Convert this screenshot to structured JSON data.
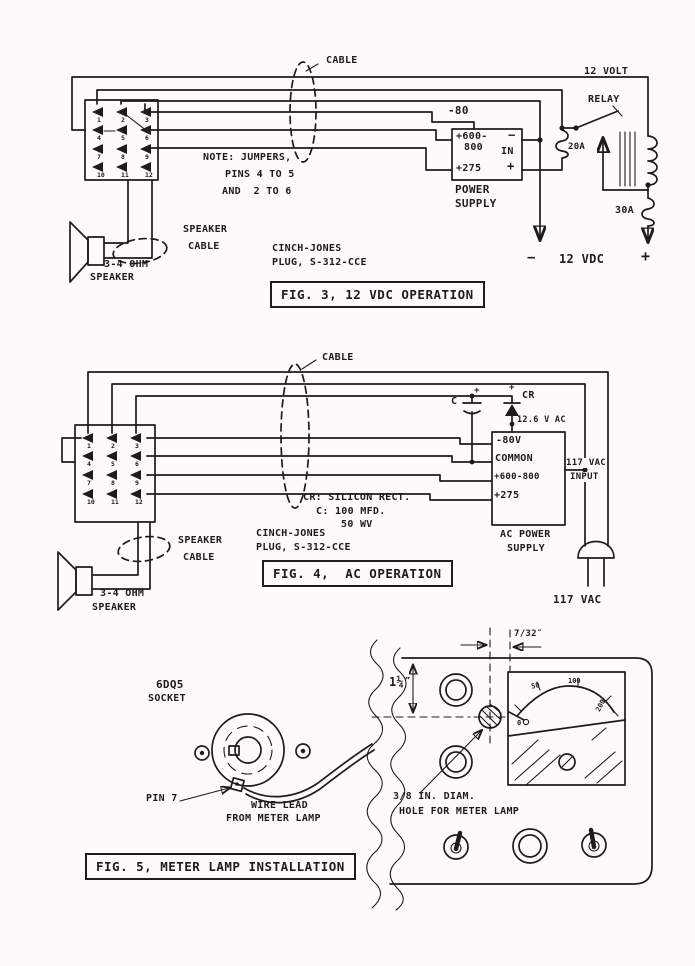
{
  "page": {
    "ink": "#1e1c1a",
    "paper": "#fcfbf7"
  },
  "fig3": {
    "cable": "CABLE",
    "note1": "NOTE: JUMPERS,",
    "note2": "PINS 4 TO 5",
    "note3": "AND  2 TO 6",
    "relay1": "12 VOLT",
    "relay2": "RELAY",
    "ps_wire": "-80",
    "ps_row1": "+600-",
    "ps_row2": "800",
    "ps_in": "IN",
    "ps_row3": "+275",
    "ps_neg": "−",
    "ps_pos": "+",
    "ps_cap1": "POWER",
    "ps_cap2": "SUPPLY",
    "fuse_20": "20A",
    "fuse_30": "30A",
    "dc_neg": "−",
    "dc": "12 VDC",
    "dc_pos": "+",
    "spkr_cable1": "SPEAKER",
    "spkr_cable2": "CABLE",
    "spkr1": "3-4 OHM",
    "spkr2": "SPEAKER",
    "plug1": "CINCH-JONES",
    "plug2": "PLUG, S-312-CCE",
    "caption": "FIG. 3, 12 VDC OPERATION",
    "pins": [
      "1",
      "2",
      "3",
      "4",
      "5",
      "6",
      "7",
      "8",
      "9",
      "10",
      "11",
      "12"
    ]
  },
  "fig4": {
    "cable": "CABLE",
    "c_plus": "+",
    "c_label": "C",
    "cr_plus": "+",
    "cr_label": "CR",
    "vac126": "12.6 V AC",
    "ps_row1": "-80V",
    "ps_row2": "COMMON",
    "ps_row3": "+600-800",
    "ps_row4": "+275",
    "ps_cap1": "AC POWER",
    "ps_cap2": "SUPPLY",
    "input1": "117 VAC",
    "input2": "INPUT",
    "vac117": "117 VAC",
    "cr_note": "CR: SILICON RECT.",
    "c_note": "C: 100 MFD.",
    "c_note2": "50 WV",
    "spkr_cable1": "SPEAKER",
    "spkr_cable2": "CABLE",
    "spkr1": "3-4 OHM",
    "spkr2": "SPEAKER",
    "plug1": "CINCH-JONES",
    "plug2": "PLUG, S-312-CCE",
    "caption": "FIG. 4,  AC OPERATION",
    "pins": [
      "1",
      "2",
      "3",
      "4",
      "5",
      "6",
      "7",
      "8",
      "9",
      "10",
      "11",
      "12"
    ]
  },
  "fig5": {
    "socket1": "6DQ5",
    "socket2": "SOCKET",
    "pin7": "PIN 7",
    "wire1": "WIRE LEAD",
    "wire2": "FROM METER LAMP",
    "dim_h": "1¼″",
    "dim_w": "7/32″",
    "hole1": "3/8 IN. DIAM.",
    "hole2": "HOLE FOR METER LAMP",
    "caption": "FIG. 5, METER LAMP INSTALLATION",
    "meter_scale": [
      "0",
      "50",
      "100",
      "200"
    ]
  }
}
